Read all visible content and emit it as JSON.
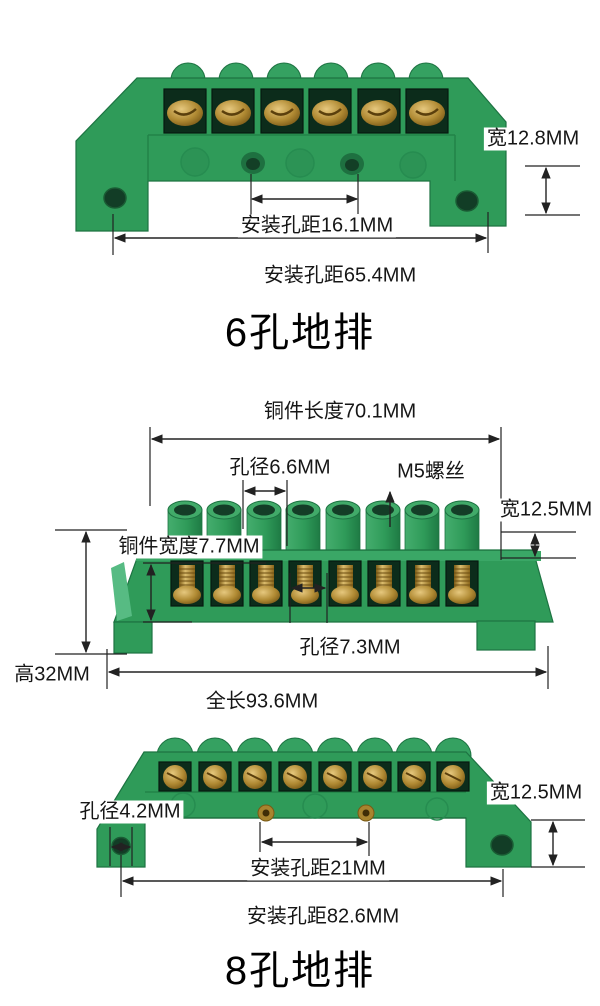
{
  "colors": {
    "body_green": "#2f9b59",
    "green_light": "#35a161",
    "green_dark": "#1d7342",
    "brass": "#a87f26",
    "dimension_line": "#222222",
    "text": "#161616"
  },
  "sections": [
    {
      "id": "six-hole-ground-bar",
      "title": "6孔地排",
      "labels": {
        "width": "宽12.8MM",
        "mount_spacing_inner": "安装孔距16.1MM",
        "mount_spacing_outer": "安装孔距65.4MM"
      }
    },
    {
      "id": "eight-hole-ground-bar-top-view",
      "labels": {
        "copper_length": "铜件长度70.1MM",
        "top_hole_diameter": "孔径6.6MM",
        "screw_type": "M5螺丝",
        "width": "宽12.5MM",
        "copper_width": "铜件宽度7.7MM",
        "front_hole_diameter": "孔径7.3MM",
        "height": "高32MM",
        "total_length": "全长93.6MM"
      }
    },
    {
      "id": "eight-hole-ground-bar-front-view",
      "title": "8孔地排",
      "labels": {
        "foot_hole_diameter": "孔径4.2MM",
        "width": "宽12.5MM",
        "mount_spacing_inner": "安装孔距21MM",
        "mount_spacing_outer": "安装孔距82.6MM"
      }
    }
  ]
}
